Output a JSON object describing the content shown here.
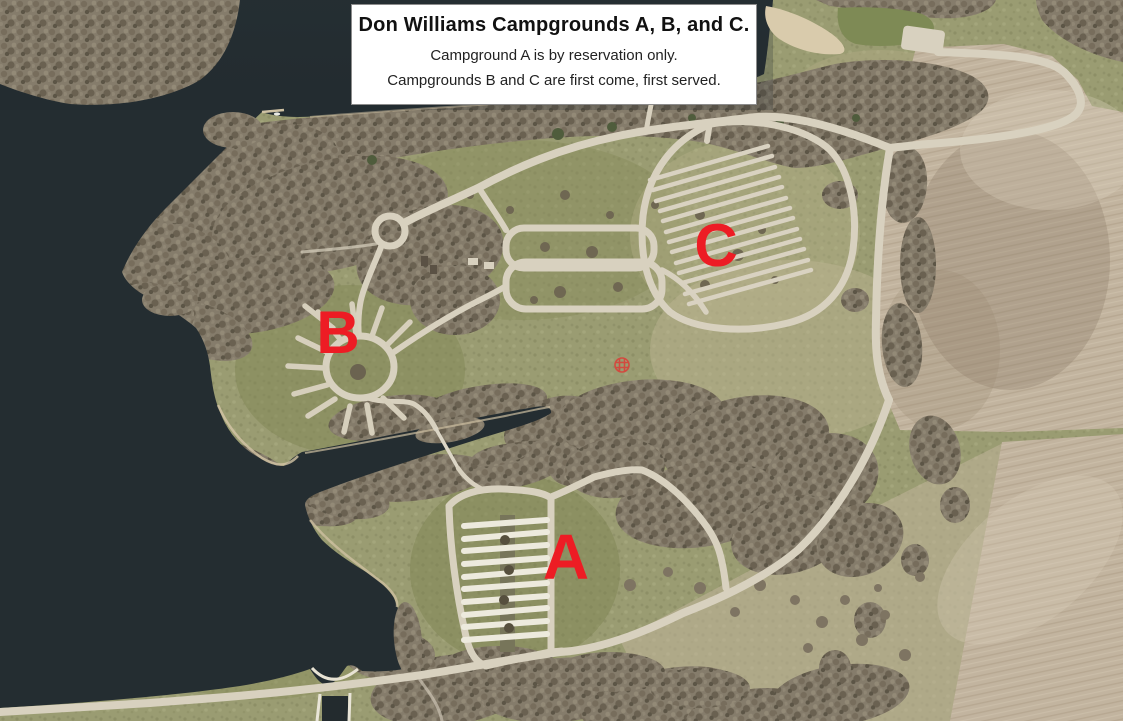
{
  "info_box": {
    "title": "Don Williams Campgrounds A, B, and C.",
    "lines": [
      "Campground A is by reservation only.",
      "Campgrounds B and C are first come, first served."
    ]
  },
  "map": {
    "labels": {
      "a": "A",
      "b": "B",
      "c": "C"
    },
    "colors": {
      "label_red": "#ed1c24",
      "marker_red": "#d9423a",
      "water": "#242d31",
      "grass": "#9a9c72",
      "field": "#c2b49f",
      "forest": "#857c6b",
      "road": "#d8d1bf",
      "pad_white": "#edeadd"
    },
    "icons": {
      "site_marker": "red-grid-circle-marker"
    }
  }
}
